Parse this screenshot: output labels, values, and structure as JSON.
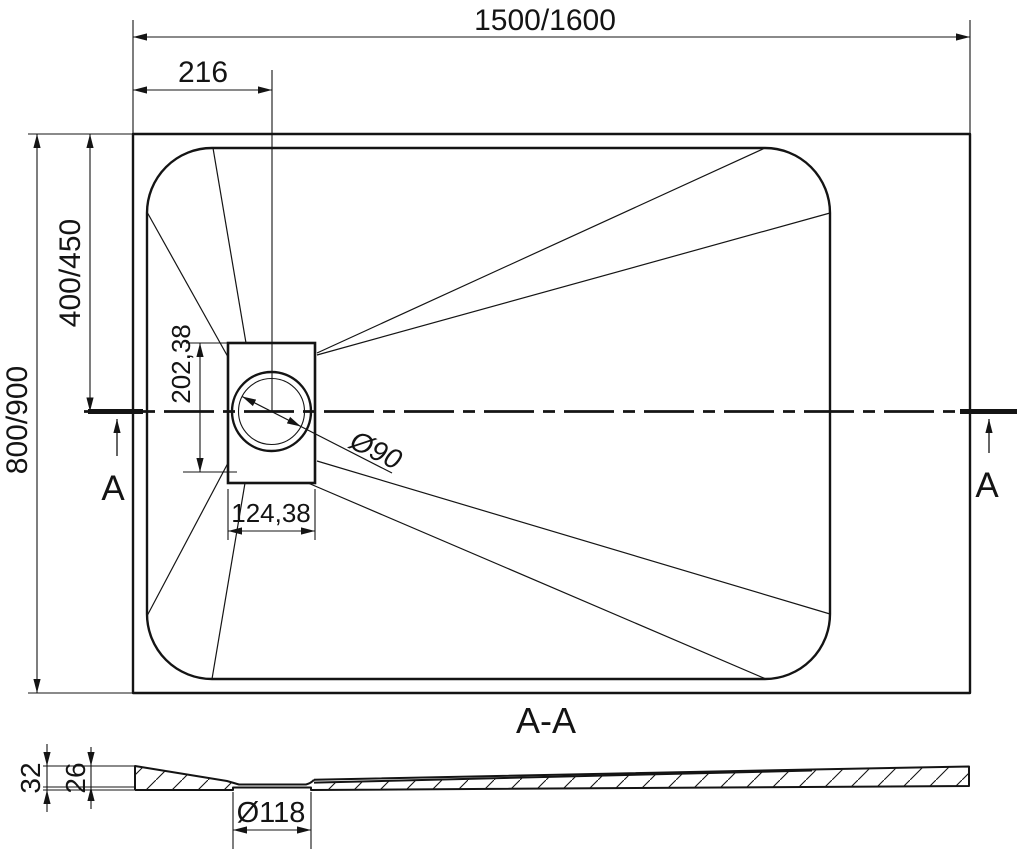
{
  "page": {
    "background": "#ffffff",
    "line_color": "#141414"
  },
  "top_view": {
    "section_marker": "A",
    "dimensions": {
      "overall_width": "1500/1600",
      "overall_depth": "800/900",
      "drain_center_from_left": "216",
      "drain_center_from_top": "400/450",
      "drain_recess_height": "202,38",
      "drain_recess_width": "124,38",
      "drain_diameter": "Ø90"
    }
  },
  "section_view": {
    "title": "A-A",
    "dimensions": {
      "overall_height": "32",
      "basin_depth": "26",
      "drain_hole_diameter": "Ø118"
    }
  }
}
